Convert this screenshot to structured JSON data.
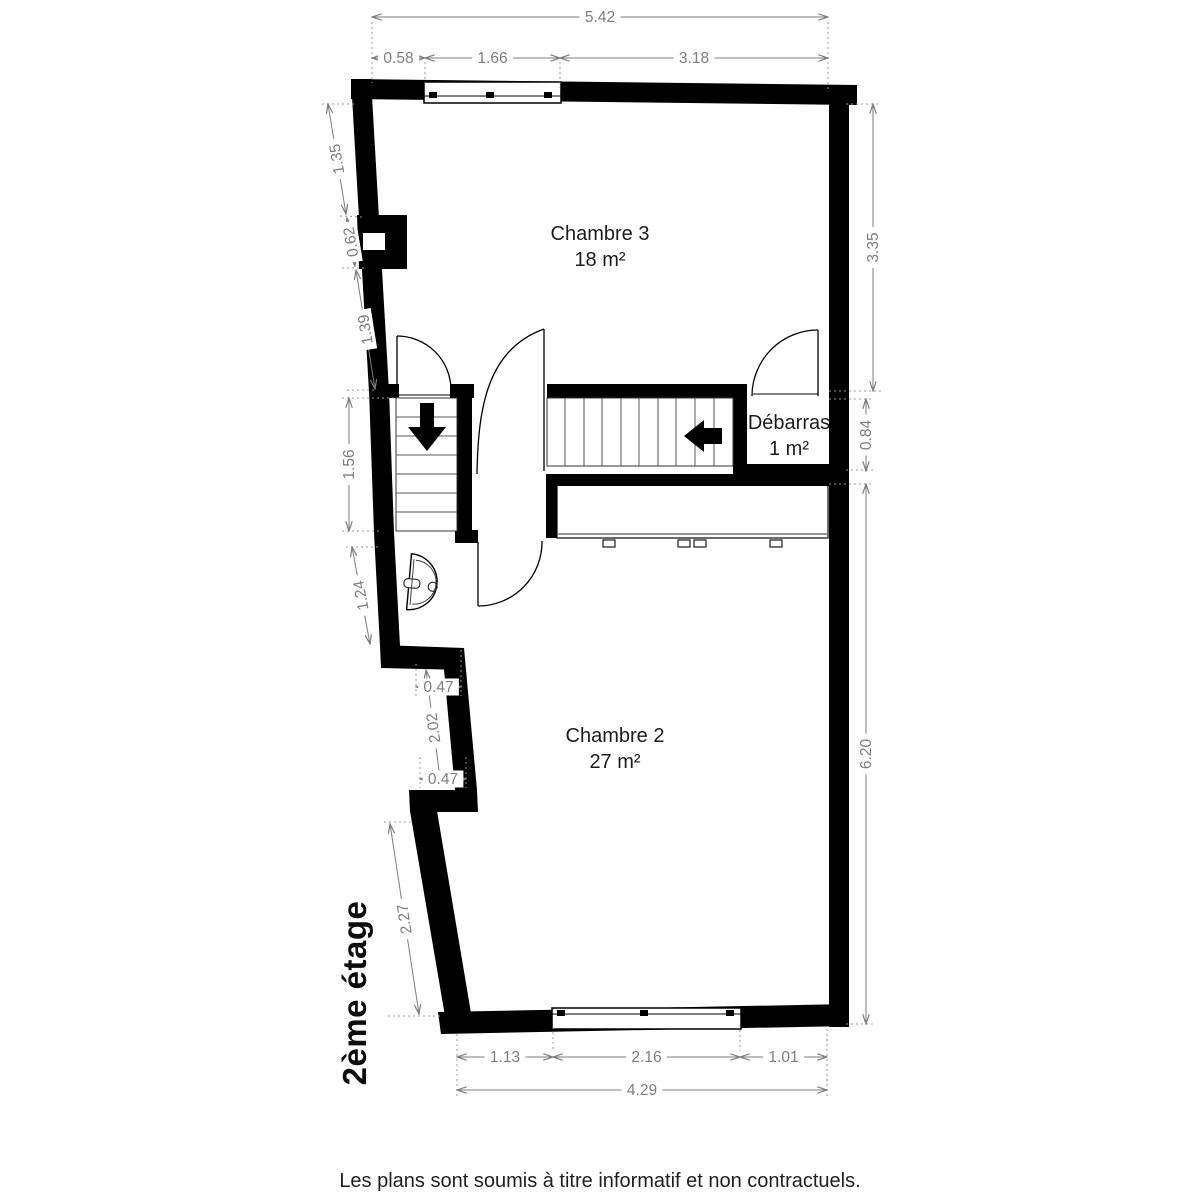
{
  "floor_label": "2ème étage",
  "footer_text": "Les plans sont soumis à titre informatif et non contractuels.",
  "rooms": [
    {
      "name": "Chambre 3",
      "area": "18 m²",
      "cx": 600,
      "cy": 240
    },
    {
      "name": "Chambre 2",
      "area": "27 m²",
      "cx": 615,
      "cy": 742
    },
    {
      "name": "Débarras",
      "area": "1 m²",
      "cx": 789,
      "cy": 429
    }
  ],
  "dimensions": [
    {
      "label": "5.42",
      "x1": 372,
      "y1": 17,
      "x2": 828,
      "y2": 17
    },
    {
      "label": "0.58",
      "x1": 372,
      "y1": 58,
      "x2": 425,
      "y2": 58
    },
    {
      "label": "1.66",
      "x1": 425,
      "y1": 58,
      "x2": 560,
      "y2": 58
    },
    {
      "label": "3.18",
      "x1": 560,
      "y1": 58,
      "x2": 828,
      "y2": 58
    },
    {
      "label": "1.13",
      "x1": 457,
      "y1": 1057,
      "x2": 553,
      "y2": 1057
    },
    {
      "label": "2.16",
      "x1": 553,
      "y1": 1057,
      "x2": 740,
      "y2": 1057
    },
    {
      "label": "1.01",
      "x1": 740,
      "y1": 1057,
      "x2": 827,
      "y2": 1057
    },
    {
      "label": "4.29",
      "x1": 457,
      "y1": 1090,
      "x2": 827,
      "y2": 1090
    },
    {
      "label": "1.35",
      "x1": 328,
      "y1": 104,
      "x2": 346,
      "y2": 214
    },
    {
      "label": "0.62",
      "x1": 347,
      "y1": 218,
      "x2": 355,
      "y2": 266
    },
    {
      "label": "1.39",
      "x1": 356,
      "y1": 270,
      "x2": 375,
      "y2": 389
    },
    {
      "label": "1.56",
      "x1": 349,
      "y1": 398,
      "x2": 349,
      "y2": 531
    },
    {
      "label": "1.24",
      "x1": 352,
      "y1": 547,
      "x2": 370,
      "y2": 644
    },
    {
      "label": "2.02",
      "x1": 426,
      "y1": 670,
      "x2": 441,
      "y2": 786
    },
    {
      "label": "0.47",
      "x1": 416,
      "y1": 687,
      "x2": 461,
      "y2": 687
    },
    {
      "label": "0.47",
      "x1": 420,
      "y1": 779,
      "x2": 466,
      "y2": 779
    },
    {
      "label": "2.27",
      "x1": 390,
      "y1": 824,
      "x2": 419,
      "y2": 1014
    },
    {
      "label": "3.35",
      "x1": 873,
      "y1": 104,
      "x2": 873,
      "y2": 391
    },
    {
      "label": "0.84",
      "x1": 866,
      "y1": 399,
      "x2": 866,
      "y2": 471
    },
    {
      "label": "6.20",
      "x1": 866,
      "y1": 484,
      "x2": 866,
      "y2": 1024
    }
  ],
  "colors": {
    "wall": "#000000",
    "dimension": "#7d7d7d",
    "room_text": "#1c1c1c"
  }
}
